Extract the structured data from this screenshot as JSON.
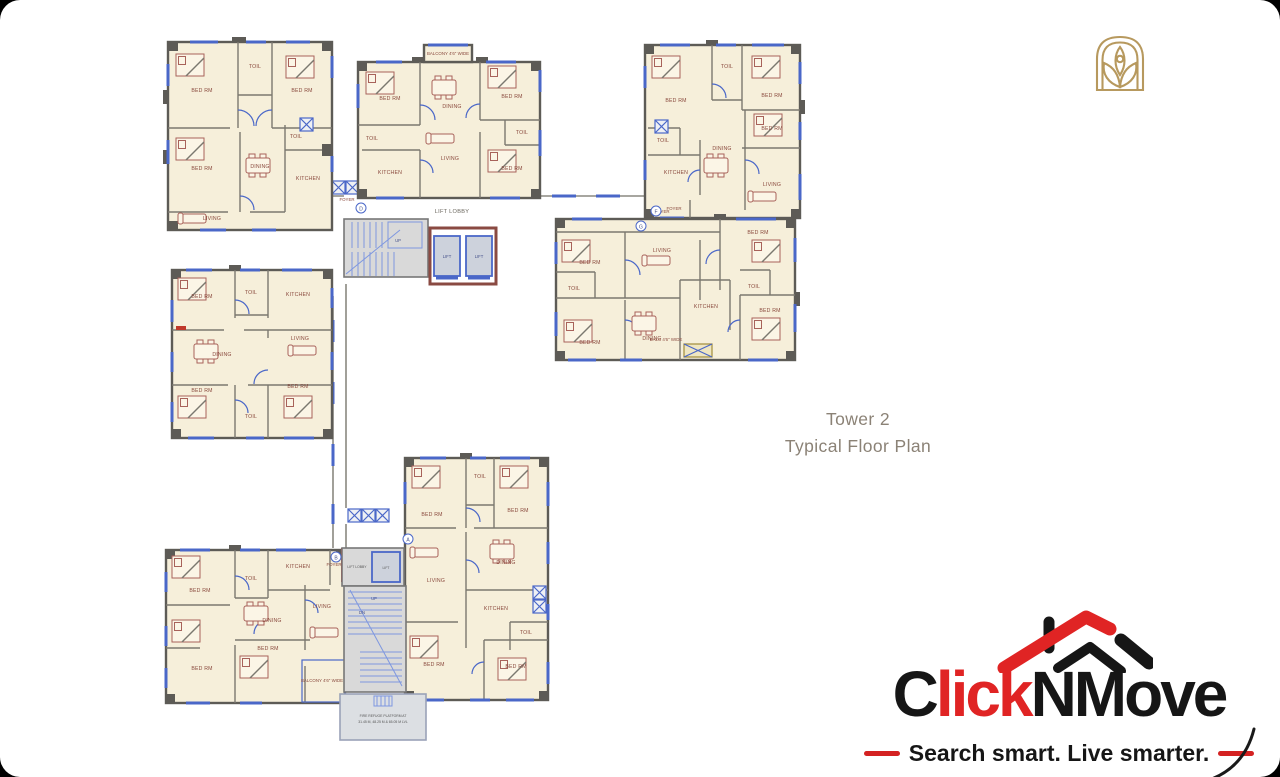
{
  "title_block": {
    "line1": "Tower 2",
    "line2": "Typical Floor Plan",
    "color": "#8b8276"
  },
  "developer_emblem": {
    "icon": "arch-lotus-emblem",
    "color": "#b7995e"
  },
  "plan": {
    "colors": {
      "floor_cream": "#f6efda",
      "wall_gray": "#5d5b56",
      "window_blue": "#4a67c8",
      "furniture_brown": "#a8625a",
      "accent_red": "#c0392b",
      "core_gray": "#d9d9d9",
      "balcony_gold": "#a08c3a"
    },
    "flat_markers": [
      "D",
      "F",
      "G",
      "A",
      "B"
    ],
    "core_top": {
      "lobby_label": "LIFT LOBBY",
      "lift1": "LIFT",
      "lift2": "LIFT",
      "up": "UP"
    },
    "core_bottom": {
      "lobby_label": "LIFT LOBBY",
      "lift": "LIFT",
      "up": "UP",
      "dn": "DN",
      "refuge_line1": "FIRE REFUGE PLATFORM AT",
      "refuge_line2": "31.45 M, 48.25 M & 65.05 M LVL"
    },
    "units": [
      {
        "id": "top-left",
        "rooms": [
          "BED RM",
          "TOIL",
          "BED RM",
          "BED RM",
          "DINING",
          "TOIL",
          "KITCHEN",
          "LIVING",
          "FOYER"
        ]
      },
      {
        "id": "top-center",
        "rooms": [
          "BALCONY 4'6\" WIDE",
          "BED RM",
          "DINING",
          "BED RM",
          "TOIL",
          "TOIL",
          "LIVING",
          "KITCHEN",
          "BED RM"
        ]
      },
      {
        "id": "top-right",
        "rooms": [
          "BED RM",
          "TOIL",
          "BED RM",
          "TOIL",
          "BED RM",
          "KITCHEN",
          "DINING",
          "LIVING",
          "FOYER"
        ]
      },
      {
        "id": "mid-right",
        "rooms": [
          "FOYER",
          "BED RM",
          "LIVING",
          "BED RM",
          "TOIL",
          "BED RM",
          "DINING",
          "KITCHEN",
          "TOIL",
          "BED RM",
          "BALC 4'6\" WIDE"
        ]
      },
      {
        "id": "mid-left",
        "rooms": [
          "BED RM",
          "TOIL",
          "KITCHEN",
          "DINING",
          "LIVING",
          "BED RM",
          "TOIL",
          "BED RM"
        ]
      },
      {
        "id": "bottom-center",
        "rooms": [
          "BED RM",
          "TOIL",
          "BED RM",
          "LIVING",
          "DINING",
          "KITCHEN",
          "TOIL",
          "BED RM",
          "BED RM"
        ]
      },
      {
        "id": "bottom-left",
        "rooms": [
          "BED RM",
          "TOIL",
          "KITCHEN",
          "FOYER",
          "DINING",
          "LIVING",
          "BED RM",
          "BED RM",
          "BALCONY 4'6\" WIDE"
        ]
      }
    ]
  },
  "brand": {
    "wordmark_c": "C",
    "wordmark_lick": "lick",
    "wordmark_nmove": "NMove",
    "tagline": "Search smart. Live smarter.",
    "red": "#e02424",
    "black": "#161616"
  }
}
